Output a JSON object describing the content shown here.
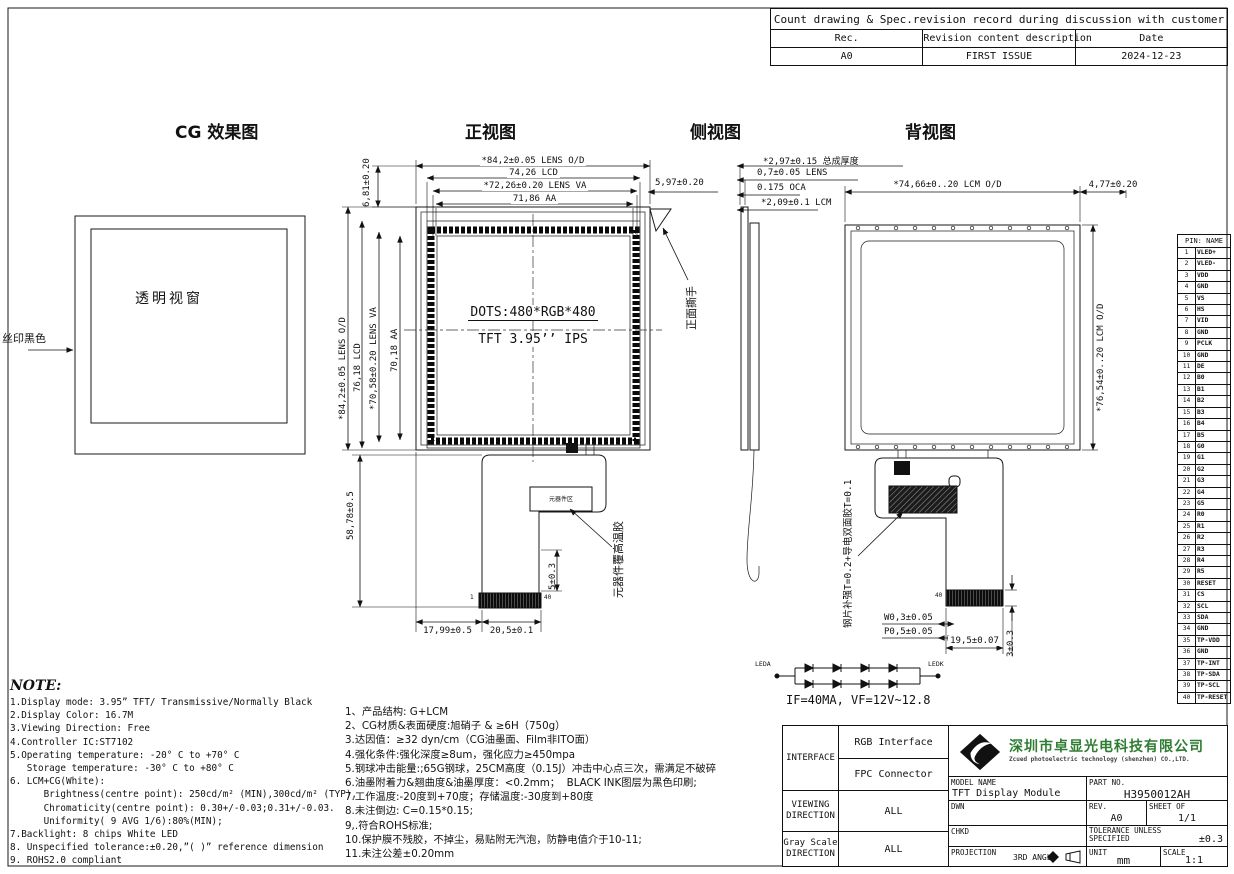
{
  "revision_table": {
    "title": "Count drawing & Spec.revision record during discussion with customer",
    "headers": [
      "Rec.",
      "Revision content description",
      "Date"
    ],
    "rows": [
      [
        "A0",
        "FIRST ISSUE",
        "2024-12-23"
      ]
    ]
  },
  "view_titles": {
    "cg": "CG 效果图",
    "front": "正视图",
    "side": "侧视图",
    "back": "背视图"
  },
  "cg_view": {
    "window_label": "透明视窗",
    "silk_label": "丝印黑色"
  },
  "front_view": {
    "dim_lens_od_h": "*84,2±0.05 LENS O/D",
    "dim_lcd_h": "74,26 LCD",
    "dim_lens_va_h": "*72,26±0.20 LENS VA",
    "dim_aa_h": "71,86 AA",
    "dim_top_left": "6,81±0.20",
    "dim_top_right": "5,97±0.20",
    "dim_lens_od_v": "*84,2±0.05 LENS O/D",
    "dim_lcd_v": "76,18 LCD",
    "dim_lens_va_v": "*70,58±0.20 LENS VA",
    "dim_aa_v": "70,18 AA",
    "dots_text": "DOTS:480*RGB*480",
    "panel_text": "TFT 3.95’’ IPS",
    "tear_tab_label": "正面撕手",
    "component_box_label": "元器件区",
    "component_glue_label": "元器件覆高温胶",
    "dim_tail_height": "58,78±0.5",
    "dim_comp_gap": "5±0.3",
    "dim_tail_offset": "17,99±0.5",
    "dim_tail_width": "20,5±0.1",
    "pin_first": "1",
    "pin_last": "40"
  },
  "side_view": {
    "dim_total": "*2,97±0.15 总成厚度",
    "dim_lens": "0,7±0.05 LENS",
    "dim_oca": "0.175 OCA",
    "dim_lcm": "*2,09±0.1 LCM"
  },
  "back_view": {
    "dim_lcm_od_h": "*74,66±0..20 LCM O/D",
    "dim_right_gap": "4,77±0.20",
    "dim_lcm_od_v": "*76,54±0..20 LCM O/D",
    "stiffener_label": "钢片补强T=0.2+导电双面胶T=0.1",
    "dim_w": "W0,3±0.05",
    "dim_p": "P0,5±0.05",
    "dim_conn_width": "19,5±0.07",
    "dim_conn_height": "3±0.3",
    "pin_last": "40"
  },
  "led_circuit": {
    "anode_label": "LEDA",
    "cathode_label": "LEDK",
    "spec": "IF=40MA, VF=12V~12.8"
  },
  "pin_table": {
    "header": "PIN: NAME",
    "pins": [
      "VLED+",
      "VLED-",
      "VDD",
      "GND",
      "VS",
      "HS",
      "VID",
      "GND",
      "PCLK",
      "GND",
      "DE",
      "B0",
      "B1",
      "B2",
      "B3",
      "B4",
      "B5",
      "G0",
      "G1",
      "G2",
      "G3",
      "G4",
      "G5",
      "R0",
      "R1",
      "R2",
      "R3",
      "R4",
      "R5",
      "RESET",
      "CS",
      "SCL",
      "SDA",
      "GND",
      "TP-VDD",
      "GND",
      "TP-INT",
      "TP-SDA",
      "TP-SCL",
      "TP-RESET"
    ]
  },
  "notes_en": {
    "heading": "NOTE:",
    "lines": [
      "1.Display mode: 3.95” TFT/ Transmissive/Normally Black",
      "2.Display Color: 16.7M",
      "3.Viewing Direction: Free",
      "4.Controller IC:ST7102",
      "5.Operating temperature: -20° C to +70° C",
      "   Storage temperature: -30° C to +80° C",
      "6. LCM+CG(White):",
      "      Brightness(centre point): 250cd/m² (MIN),300cd/m² (TYP),",
      "      Chromaticity(centre point): 0.30+/-0.03;0.31+/-0.03.",
      "      Uniformity( 9 AVG 1/6):80%(MIN);",
      "7.Backlight: 8 chips White LED",
      "8. Unspecified tolerance:±0.20,”( )” reference dimension",
      "9. ROHS2.0 compliant"
    ]
  },
  "notes_cn": {
    "lines": [
      "1、产品结构: G+LCM",
      "2、CG材质&表面硬度:旭硝子 & ≥6H（750g）",
      "3.达因值：≥32 dyn/cm（CG油墨面、Film非ITO面）",
      "4.强化条件:强化深度≥8um，强化应力≥450mpa",
      "5.钢球冲击能量:;65G钢球，25CM高度（0.15J）冲击中心点三次，需满足不破碎",
      "6.油墨附着力&翘曲度&油墨厚度：<0.2mm；  BLACK INK图层为黑色印刷;",
      "7.工作温度:-20度到+70度；存储温度:-30度到+80度",
      "8.未注倒边: C=0.15*0.15;",
      "9,.符合ROHS标准;",
      "10.保护膜不残胶，不掉尘，易贴附无汽泡，防静电值介于10-11;",
      "11.未注公差±0.20mm"
    ]
  },
  "title_block": {
    "interface_label": "INTERFACE",
    "interface_rgb": "RGB Interface",
    "interface_fpc": "FPC Connector",
    "viewing_label": "VIEWING\nDIRECTION",
    "viewing_value": "ALL",
    "gray_label": "Gray Scale\nDIRECTION",
    "gray_value": "ALL",
    "company_cn": "深圳市卓显光电科技有限公司",
    "company_en": "Zcued photoelectric technology (shenzhen) CO.,LTD.",
    "model_label": "MODEL NAME",
    "model_value": "TFT Display Module",
    "part_label": "PART NO.",
    "part_value": "H3950012AH",
    "dwn_label": "DWN",
    "chkd_label": "CHKD",
    "rev_label": "REV.",
    "rev_value": "A0",
    "sheet_label": "SHEET OF",
    "sheet_value": "1/1",
    "tol_label": "TOLERANCE UNLESS\nSPECIFIED",
    "tol_value": "±0.3",
    "projection_label": "PROJECTION",
    "projection_value": "3RD ANGLE",
    "unit_label": "UNIT",
    "unit_value": "mm",
    "scale_label": "SCALE",
    "scale_value": "1:1"
  }
}
